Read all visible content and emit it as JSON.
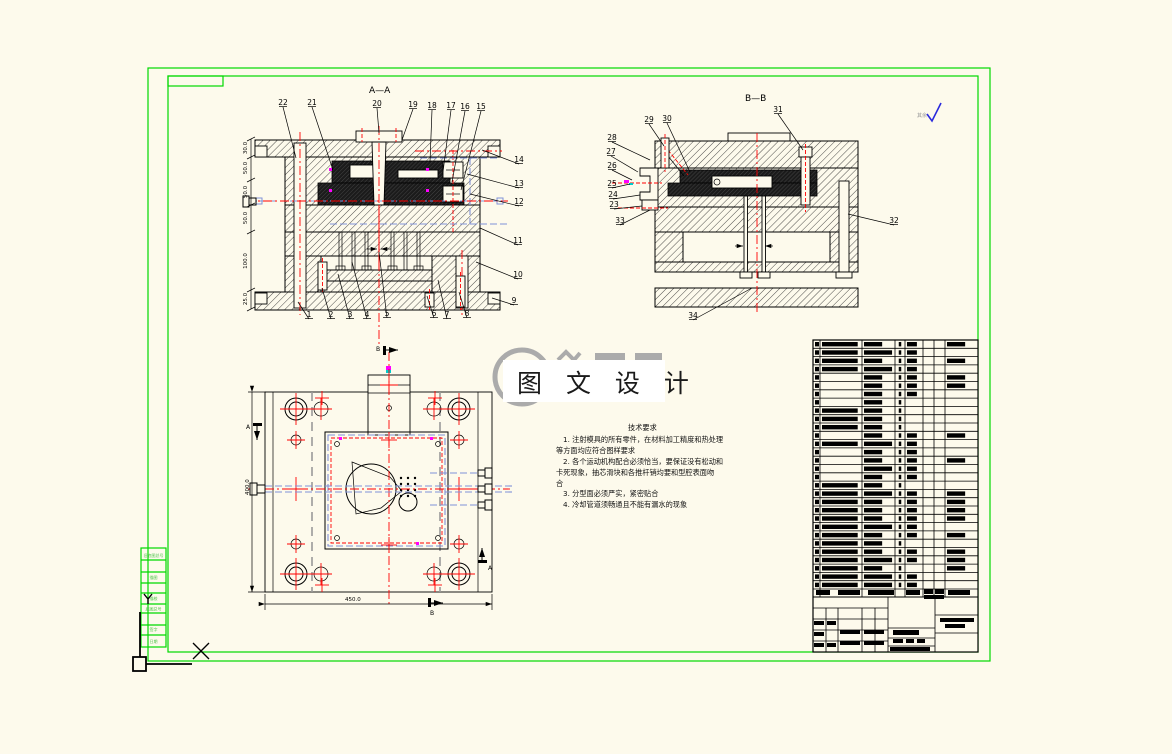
{
  "canvas": {
    "bg": "#FDFAEC",
    "frame_green": "#00D900",
    "line_black": "#000000",
    "center_red": "#FF0000",
    "cooling_blue": "#8091D8",
    "magenta": "#FF00FF"
  },
  "views": {
    "aa": {
      "title": "A—A",
      "callouts": [
        {
          "n": "1",
          "x": 309,
          "y": 317,
          "tx": 298,
          "ty": 302
        },
        {
          "n": "2",
          "x": 331,
          "y": 317,
          "tx": 322,
          "ty": 288
        },
        {
          "n": "3",
          "x": 350,
          "y": 317,
          "tx": 338,
          "ty": 274
        },
        {
          "n": "4",
          "x": 367,
          "y": 317,
          "tx": 352,
          "ty": 262
        },
        {
          "n": "5",
          "x": 387,
          "y": 316,
          "tx": 379,
          "ty": 252
        },
        {
          "n": "6",
          "x": 434,
          "y": 316,
          "tx": 427,
          "ty": 296
        },
        {
          "n": "7",
          "x": 447,
          "y": 317,
          "tx": 438,
          "ty": 280
        },
        {
          "n": "8",
          "x": 467,
          "y": 316,
          "tx": 459,
          "ty": 292
        },
        {
          "n": "9",
          "x": 514,
          "y": 303,
          "tx": 492,
          "ty": 298
        },
        {
          "n": "10",
          "x": 518,
          "y": 277,
          "tx": 476,
          "ty": 262
        },
        {
          "n": "11",
          "x": 518,
          "y": 243,
          "tx": 480,
          "ty": 228
        },
        {
          "n": "12",
          "x": 519,
          "y": 204,
          "tx": 470,
          "ty": 194
        },
        {
          "n": "13",
          "x": 519,
          "y": 186,
          "tx": 467,
          "ty": 174
        },
        {
          "n": "14",
          "x": 519,
          "y": 162,
          "tx": 482,
          "ty": 150
        },
        {
          "n": "15",
          "x": 481,
          "y": 109,
          "tx": 461,
          "ty": 190
        },
        {
          "n": "16",
          "x": 465,
          "y": 109,
          "tx": 452,
          "ty": 182
        },
        {
          "n": "17",
          "x": 451,
          "y": 108,
          "tx": 443,
          "ty": 172
        },
        {
          "n": "18",
          "x": 432,
          "y": 108,
          "tx": 430,
          "ty": 162
        },
        {
          "n": "19",
          "x": 413,
          "y": 107,
          "tx": 402,
          "ty": 140
        },
        {
          "n": "20",
          "x": 377,
          "y": 106,
          "tx": 379,
          "ty": 133
        },
        {
          "n": "21",
          "x": 312,
          "y": 105,
          "tx": 333,
          "ty": 170
        },
        {
          "n": "22",
          "x": 283,
          "y": 105,
          "tx": 296,
          "ty": 158
        }
      ],
      "dims": [
        {
          "t": "30.0",
          "y": 148
        },
        {
          "t": "50.0",
          "y": 168
        },
        {
          "t": "50.0",
          "y": 192
        },
        {
          "t": "50.0",
          "y": 218
        },
        {
          "t": "100.0",
          "y": 261
        },
        {
          "t": "25.0",
          "y": 299
        }
      ]
    },
    "bb": {
      "title": "B—B",
      "callouts": [
        {
          "n": "23",
          "x": 614,
          "y": 207,
          "tx": 642,
          "ty": 206
        },
        {
          "n": "24",
          "x": 613,
          "y": 197,
          "tx": 640,
          "ty": 195
        },
        {
          "n": "25",
          "x": 612,
          "y": 186,
          "tx": 630,
          "ty": 184
        },
        {
          "n": "26",
          "x": 612,
          "y": 168,
          "tx": 632,
          "ty": 180
        },
        {
          "n": "27",
          "x": 611,
          "y": 154,
          "tx": 638,
          "ty": 172
        },
        {
          "n": "28",
          "x": 612,
          "y": 140,
          "tx": 650,
          "ty": 160
        },
        {
          "n": "29",
          "x": 649,
          "y": 122,
          "tx": 664,
          "ty": 146
        },
        {
          "n": "30",
          "x": 667,
          "y": 121,
          "tx": 690,
          "ty": 172
        },
        {
          "n": "31",
          "x": 778,
          "y": 112,
          "tx": 803,
          "ty": 150
        },
        {
          "n": "32",
          "x": 894,
          "y": 223,
          "tx": 848,
          "ty": 214
        },
        {
          "n": "33",
          "x": 620,
          "y": 223,
          "tx": 650,
          "ty": 210
        },
        {
          "n": "34",
          "x": 693,
          "y": 318,
          "tx": 752,
          "ty": 288
        }
      ]
    },
    "plan": {
      "width_dim": "450.0",
      "height_dim": "400.0",
      "markers": [
        {
          "t": "B",
          "x": 379,
          "y": 348
        },
        {
          "t": "B",
          "x": 433,
          "y": 612
        },
        {
          "t": "A",
          "x": 250,
          "y": 427
        },
        {
          "t": "A",
          "x": 487,
          "y": 566
        }
      ]
    }
  },
  "watermark": {
    "text": "图 文 设 计"
  },
  "roughness": {
    "prefix": "其余",
    "mark": "√"
  },
  "tech": {
    "title": "技术要求",
    "lines": [
      "1.  注射模具的所有零件，在材料加工精度和热处理",
      "等方面均应符合图样要求",
      "2.  各个运动机构配合必须恰当，要保证没有松动和",
      "卡死现象，抽芯滑块和各推杆销均要和型腔表面吻",
      "合",
      "3.  分型面必须严实，紧密贴合",
      "4.  冷却管道须畅通且不能有漏水的现象"
    ]
  },
  "margin_strip": {
    "labels": [
      {
        "t": "旧底图总号",
        "y": 557
      },
      {
        "t": "描图",
        "y": 579
      },
      {
        "t": "描校",
        "y": 600
      },
      {
        "t": "底图总号",
        "y": 610
      },
      {
        "t": "签字",
        "y": 631
      },
      {
        "t": "日期",
        "y": 643
      }
    ]
  },
  "bom": {
    "rows": [
      [
        1,
        2,
        1,
        1,
        1,
        0,
        0,
        1
      ],
      [
        1,
        2,
        2,
        1,
        1,
        0,
        0,
        0
      ],
      [
        1,
        2,
        1,
        1,
        1,
        0,
        0,
        1
      ],
      [
        1,
        2,
        2,
        1,
        1,
        0,
        0,
        0
      ],
      [
        1,
        0,
        1,
        1,
        1,
        0,
        0,
        1
      ],
      [
        1,
        0,
        1,
        1,
        1,
        0,
        0,
        1
      ],
      [
        1,
        0,
        1,
        1,
        1,
        0,
        0,
        0
      ],
      [
        1,
        0,
        1,
        1,
        0,
        0,
        0,
        0
      ],
      [
        1,
        2,
        1,
        1,
        0,
        0,
        0,
        0
      ],
      [
        1,
        2,
        1,
        1,
        0,
        0,
        0,
        0
      ],
      [
        1,
        2,
        1,
        1,
        0,
        0,
        0,
        0
      ],
      [
        1,
        0,
        1,
        1,
        1,
        0,
        0,
        1
      ],
      [
        1,
        2,
        2,
        1,
        1,
        0,
        0,
        0
      ],
      [
        1,
        0,
        1,
        1,
        1,
        0,
        0,
        0
      ],
      [
        1,
        0,
        1,
        1,
        1,
        0,
        0,
        1
      ],
      [
        1,
        0,
        2,
        1,
        1,
        0,
        0,
        0
      ],
      [
        1,
        0,
        1,
        1,
        1,
        0,
        0,
        0
      ],
      [
        1,
        2,
        1,
        1,
        0,
        0,
        0,
        0
      ],
      [
        1,
        2,
        2,
        1,
        1,
        0,
        0,
        1
      ],
      [
        1,
        2,
        1,
        1,
        1,
        0,
        0,
        1
      ],
      [
        1,
        2,
        1,
        1,
        1,
        0,
        0,
        1
      ],
      [
        1,
        2,
        1,
        1,
        1,
        0,
        0,
        1
      ],
      [
        1,
        2,
        2,
        1,
        1,
        0,
        0,
        0
      ],
      [
        1,
        2,
        1,
        1,
        1,
        0,
        0,
        1
      ],
      [
        1,
        2,
        1,
        1,
        0,
        0,
        0,
        0
      ],
      [
        1,
        2,
        1,
        1,
        1,
        0,
        0,
        1
      ],
      [
        1,
        2,
        2,
        1,
        1,
        0,
        0,
        1
      ],
      [
        1,
        2,
        1,
        1,
        0,
        0,
        0,
        1
      ],
      [
        1,
        2,
        2,
        1,
        1,
        0,
        0,
        0
      ],
      [
        1,
        2,
        2,
        1,
        1,
        0,
        0,
        0
      ]
    ],
    "title_bars": [
      [
        816,
        590,
        14,
        5
      ],
      [
        838,
        590,
        22,
        5
      ],
      [
        868,
        590,
        26,
        5
      ],
      [
        906,
        590,
        14,
        5
      ],
      [
        924,
        589,
        9,
        5
      ],
      [
        935,
        589,
        9,
        5
      ],
      [
        924,
        595,
        20,
        4
      ],
      [
        948,
        590,
        22,
        5
      ],
      [
        814,
        621,
        10,
        4
      ],
      [
        827,
        621,
        9,
        4
      ],
      [
        814,
        632,
        10,
        4
      ],
      [
        840,
        630,
        20,
        4
      ],
      [
        864,
        630,
        20,
        4
      ],
      [
        814,
        643,
        10,
        4
      ],
      [
        827,
        643,
        9,
        4
      ],
      [
        840,
        641,
        20,
        4
      ],
      [
        864,
        641,
        20,
        4
      ],
      [
        893,
        630,
        26,
        5
      ],
      [
        893,
        639,
        10,
        4
      ],
      [
        906,
        639,
        8,
        4
      ],
      [
        917,
        639,
        8,
        4
      ],
      [
        890,
        647,
        40,
        4
      ],
      [
        940,
        618,
        34,
        4
      ],
      [
        945,
        624,
        20,
        4
      ]
    ]
  }
}
